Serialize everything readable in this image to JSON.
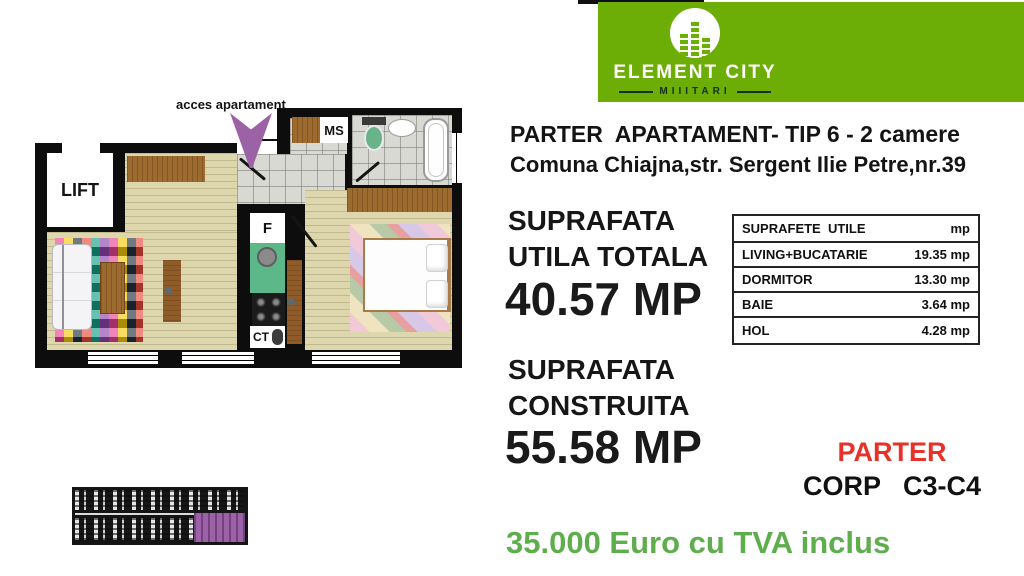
{
  "logo": {
    "name": "ELEMENT CITY",
    "subtitle": "MIIITARI",
    "bg_color": "#6cae06"
  },
  "header": {
    "line1": "PARTER  APARTAMENT- TIP 6 - 2 camere",
    "line2": "Comuna Chiajna,str. Sergent Ilie Petre,nr.39"
  },
  "useful_area": {
    "label_line1": "SUPRAFATA",
    "label_line2": "UTILA TOTALA",
    "value": "40.57 MP"
  },
  "built_area": {
    "label_line1": "SUPRAFATA",
    "label_line2": "CONSTRUITA",
    "value": "55.58 MP"
  },
  "areas_table": {
    "header": {
      "label": "SUPRAFETE  UTILE",
      "unit": "mp"
    },
    "rows": [
      {
        "label": "LIVING+BUCATARIE",
        "value": "19.35 mp"
      },
      {
        "label": "DORMITOR",
        "value": "13.30 mp"
      },
      {
        "label": "BAIE",
        "value": "3.64 mp"
      },
      {
        "label": "HOL",
        "value": "4.28 mp"
      }
    ]
  },
  "location": {
    "floor_label": "PARTER",
    "corp_label": "CORP   C3-C4"
  },
  "price": {
    "text": "35.000 Euro cu TVA inclus"
  },
  "floorplan": {
    "access_label": "acces apartament",
    "lift_label": "LIFT",
    "storage_label": "MS",
    "fridge_label": "F",
    "boiler_label": "CT"
  },
  "colors": {
    "brand_green": "#6cae06",
    "price_green": "#5fae4e",
    "floor_red": "#e63228",
    "unit_purple": "#9c62a6"
  }
}
